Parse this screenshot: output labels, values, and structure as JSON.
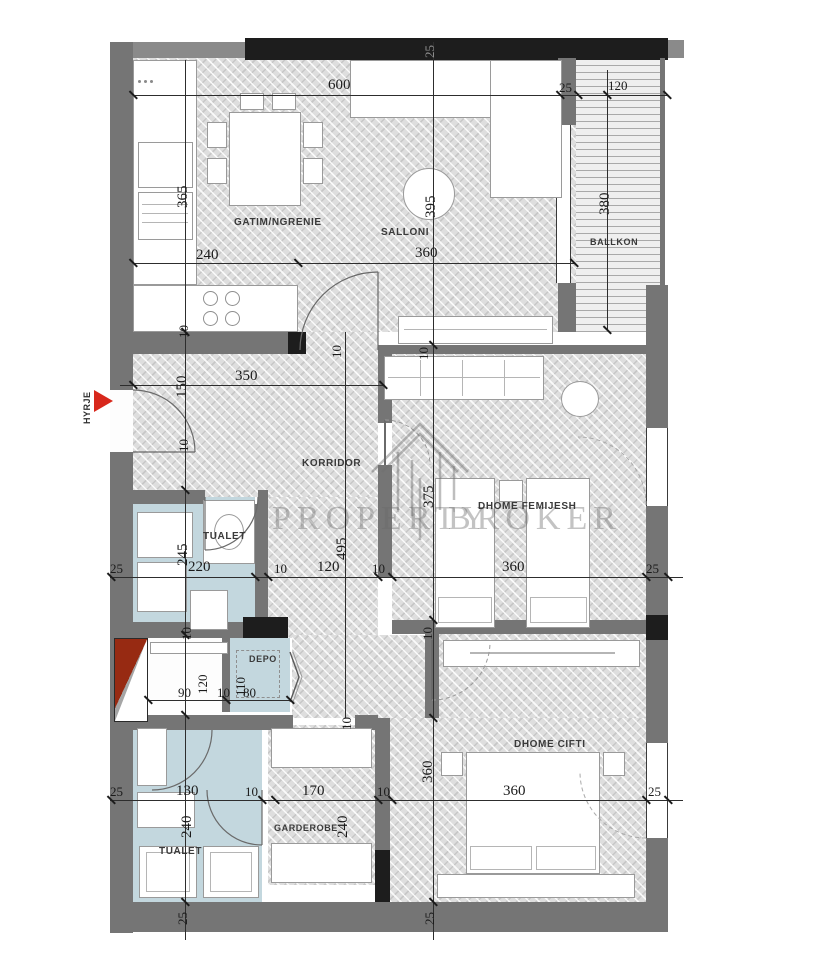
{
  "plan": {
    "title": "apartment-floor-plan",
    "rooms": {
      "kitchen": "GATIM/NGRENIE",
      "living": "SALLONI",
      "balcony": "BALLKON",
      "corridor": "KORRIDOR",
      "toilet_mid": "TUALET",
      "kids_room": "DHOME FEMIJESH",
      "storage": "DEPO",
      "toilet_bottom": "TUALET",
      "wardrobe_room": "GARDEROBE",
      "master_room": "DHOME CIFTI",
      "entrance": "HYRJE"
    },
    "watermark": {
      "line1": "PROPERTY",
      "line2": "BROKER"
    },
    "dims": {
      "n600": "600",
      "n365": "365",
      "n395": "395",
      "n380": "380",
      "n240": "240",
      "n360": "360",
      "n350": "350",
      "n150": "150",
      "n245": "245",
      "n495": "495",
      "n375": "375",
      "n220": "220",
      "n120": "120",
      "n130": "130",
      "n170": "170",
      "n110": "110",
      "n90": "90",
      "n80": "80",
      "n25": "25",
      "n10": "10"
    },
    "colors": {
      "wall_gray": "#757575",
      "wall_black": "#1d1d1d",
      "floor_blue": "#c3d7de",
      "accent_red": "#d8281c"
    }
  }
}
